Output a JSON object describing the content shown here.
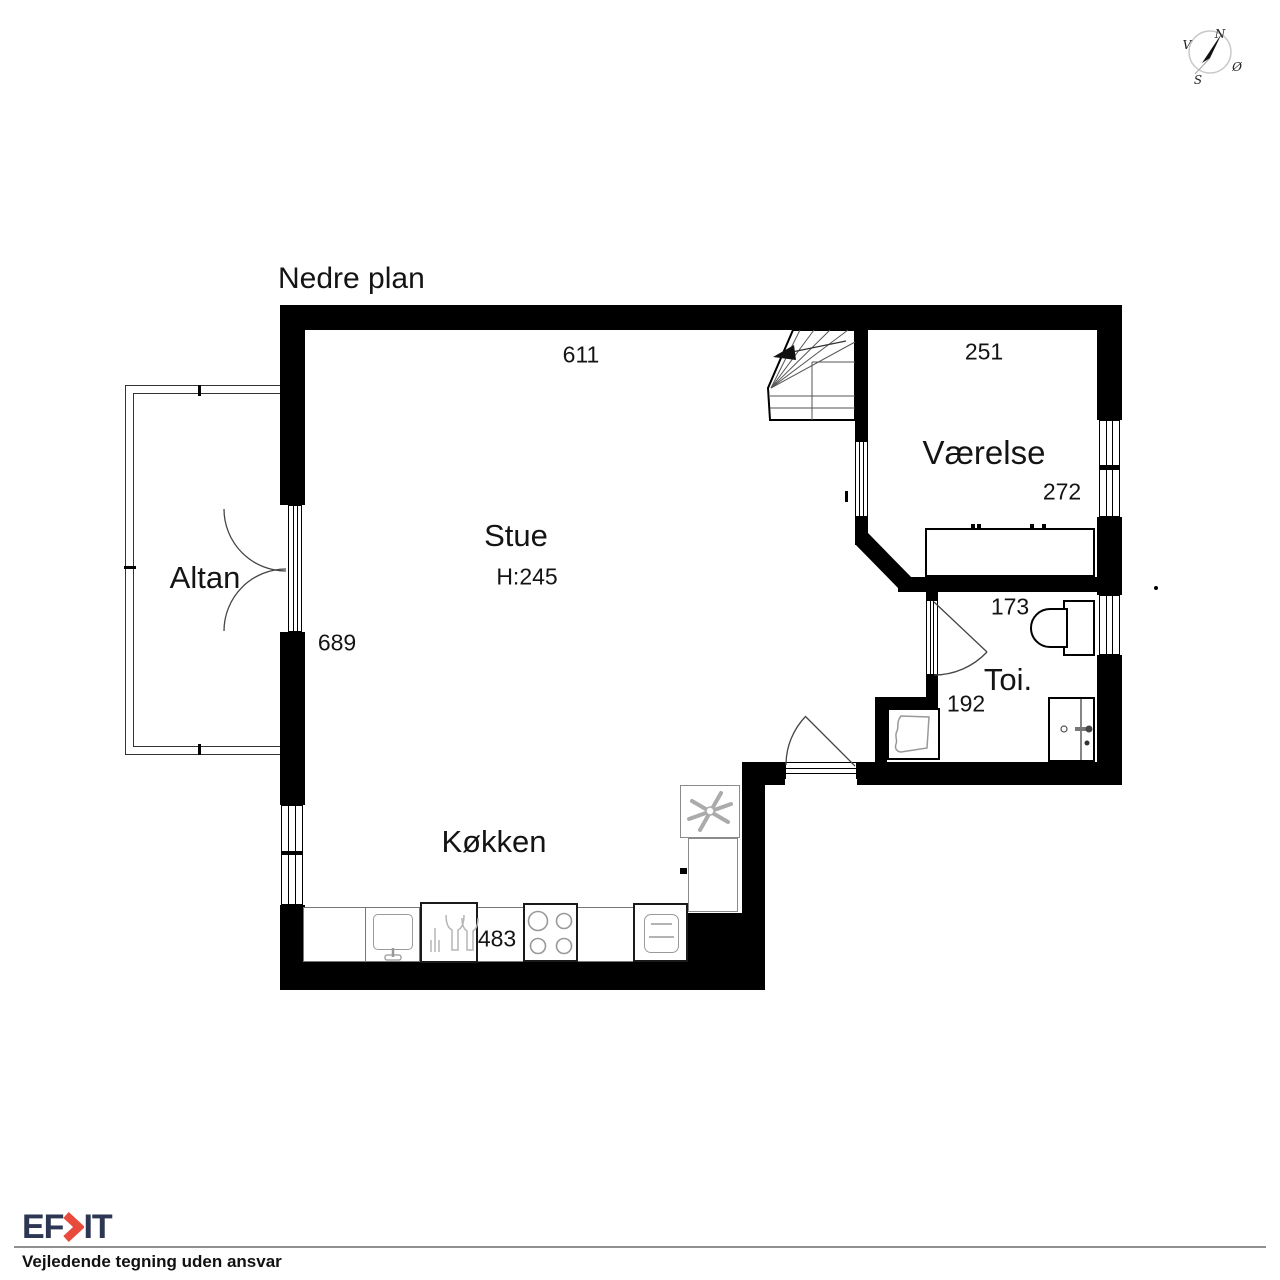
{
  "title": "Nedre plan",
  "rooms": {
    "stue": {
      "name": "Stue",
      "ceiling_height": "H:245",
      "width_cm": "611",
      "depth_cm": "689"
    },
    "vaerelse": {
      "name": "Værelse",
      "width_cm": "251",
      "depth_cm": "272"
    },
    "toi": {
      "name": "Toi.",
      "width_cm": "173",
      "depth_cm": "192"
    },
    "koekken": {
      "name": "Køkken",
      "width_cm": "483"
    },
    "altan": {
      "name": "Altan"
    }
  },
  "compass": {
    "north": "N",
    "south": "S",
    "west": "V",
    "east": "Ø"
  },
  "footer": {
    "logo_left": "EF",
    "logo_right": "IT",
    "disclaimer": "Vejledende tegning uden ansvar"
  },
  "colors": {
    "wall": "#000000",
    "logo_navy": "#2d3652",
    "logo_red": "#e84b3c"
  }
}
